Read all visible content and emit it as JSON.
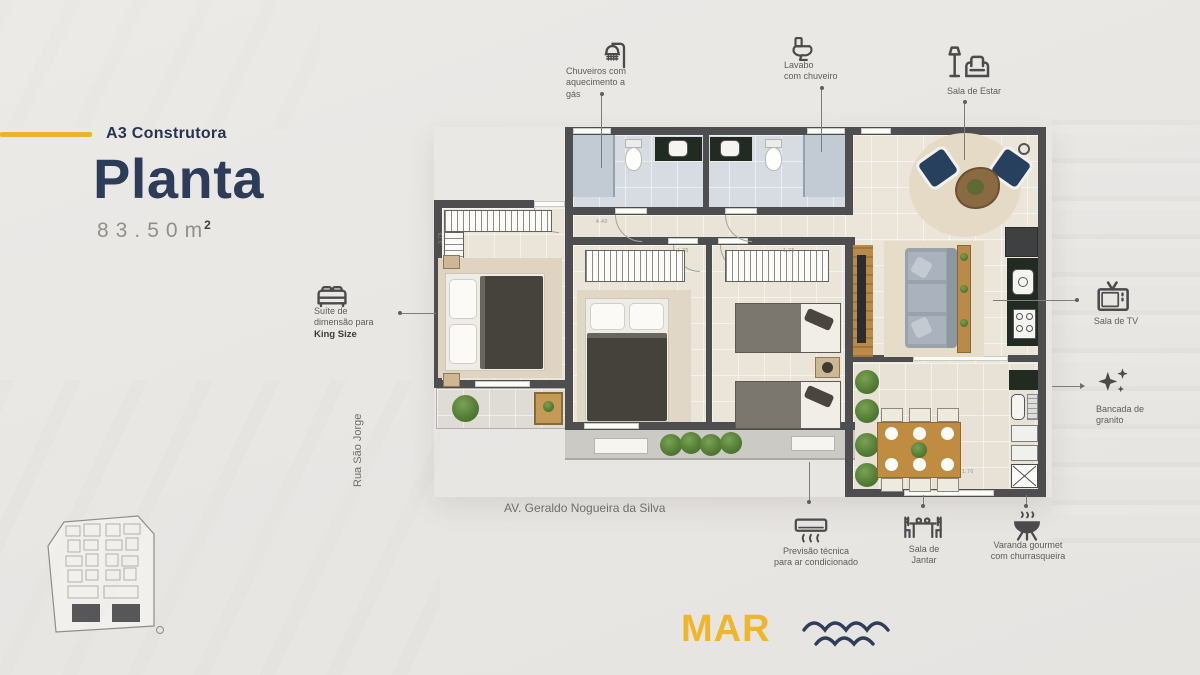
{
  "header": {
    "company": "A3 Construtora",
    "title": "Planta",
    "area_value": "83.50",
    "area_unit": "m",
    "area_exp": "2"
  },
  "callouts": {
    "shower": "Chuveiros com\naquecimento a\ngás",
    "lavabo": "Lavabo\ncom chuveiro",
    "estar": "Sala de Estar",
    "tv": "Sala de TV",
    "bancada": "Bancada de\ngranito",
    "suite_prefix": "Suíte de\ndimensão para",
    "suite_bold": "King Size",
    "ac": "Previsão técnica\npara ar condicionado",
    "jantar": "Sala de\nJantar",
    "varanda": "Varanda gourmet\ncom churrasqueira"
  },
  "streets": {
    "left": "Rua São Jorge",
    "bottom": "AV. Geraldo Nogueira da Silva"
  },
  "sea": {
    "label": "MAR"
  },
  "plan": {
    "dims": [
      "4.40",
      "3.75",
      "1.75",
      "1.75",
      "1.70"
    ]
  },
  "colors": {
    "accent": "#eeb32c",
    "navy": "#2d3c58",
    "wall": "#4e4e50"
  }
}
